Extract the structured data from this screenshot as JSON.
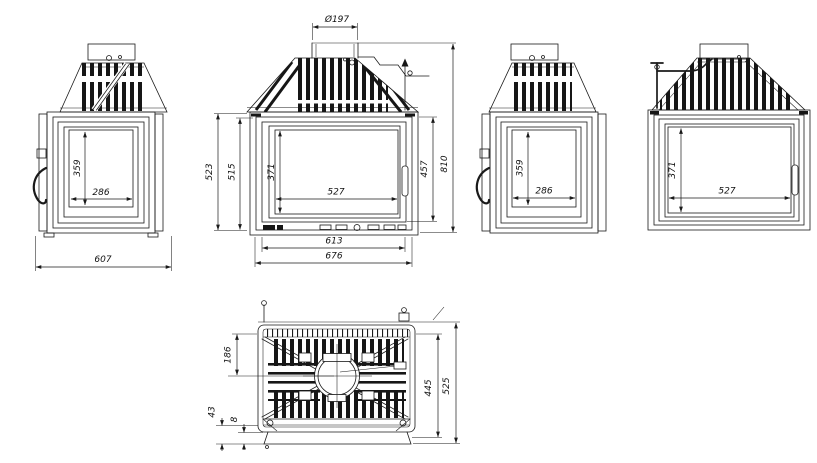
{
  "drawing": {
    "colors": {
      "background": "#ffffff",
      "line": "#1a1a1a"
    },
    "views": {
      "side_left": {
        "window_height": "359",
        "window_width": "286",
        "overall_width": "607"
      },
      "front_main": {
        "flue_diameter": "Ø197",
        "height_outer": "523",
        "height_inner": "515",
        "glass_height": "371",
        "glass_width": "527",
        "door_height": "457",
        "overall_height": "810",
        "base_width": "613",
        "overall_width": "676"
      },
      "side_right": {
        "window_height": "359",
        "window_width": "286"
      },
      "front_plain": {
        "glass_height": "371",
        "glass_width": "527"
      },
      "top": {
        "back_to_flue_center": "186",
        "front_offset": "43",
        "front_lip": "8",
        "body_depth": "445",
        "overall_depth": "525"
      }
    }
  }
}
